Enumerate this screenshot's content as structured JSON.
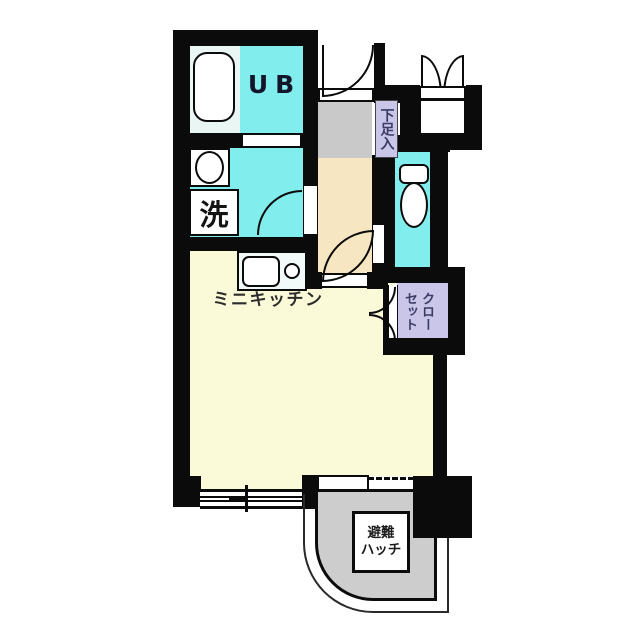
{
  "plan_title": "studio-apartment-floor-plan",
  "colors": {
    "wall": "#0b0b0b",
    "cyan_room": "#82eded",
    "tub_zone": "#eaf6f4",
    "main_room": "#fafad8",
    "corridor": "#f6e6c2",
    "entrance_gray": "#c9c9c9",
    "balcony_gray": "#cdcdcd",
    "label_purple": "#c9c6ea",
    "fixture_white": "#ffffff",
    "purple_text": "#3b3b63"
  },
  "rooms": {
    "unit_bath": {
      "label": "UB"
    },
    "laundry_room": {
      "label": "洗"
    },
    "entrance": {
      "shoe_cabinet_label": "下足入"
    },
    "main_room": {
      "kitchen_label": "ミニキッチン"
    },
    "closet": {
      "label": "クロー\nセット"
    },
    "balcony": {
      "hatch_label": "避難\nハッチ"
    }
  }
}
